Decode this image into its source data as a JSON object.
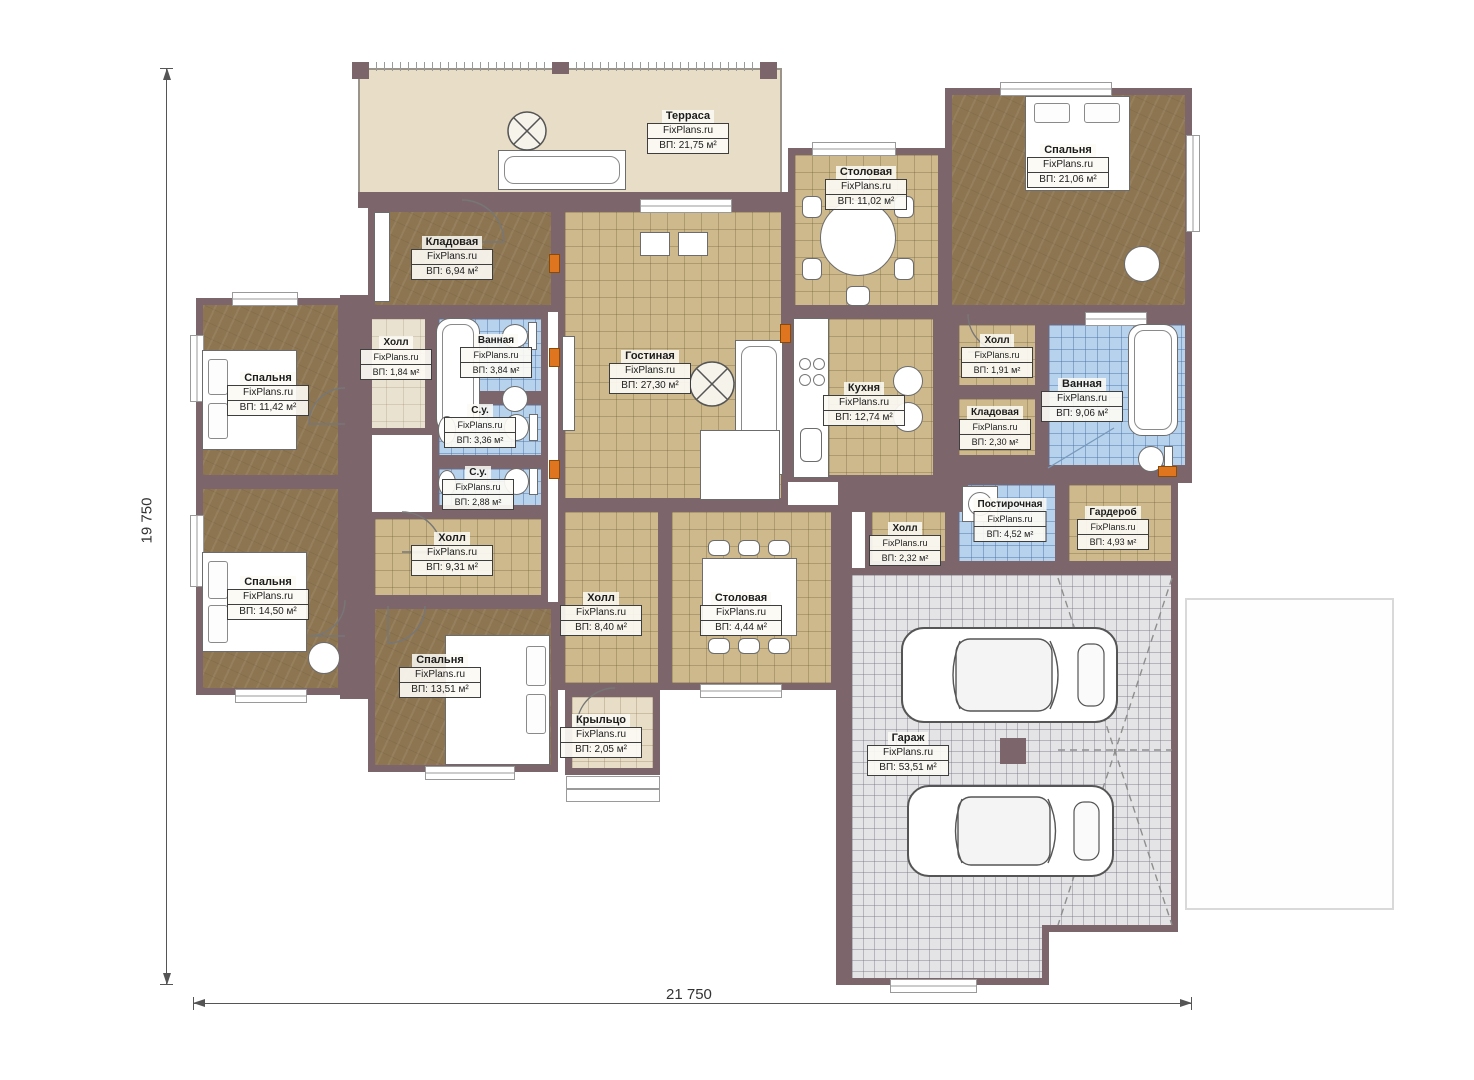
{
  "watermark": "FixPlans.ru",
  "dimensions": {
    "horizontal": "21 750",
    "vertical": "19 750"
  },
  "palette": {
    "wall": "#7c666b",
    "wood": "#8d7551",
    "tile": "#cdb98c",
    "blue": "#b7d2ec",
    "garage": "#e4e4e6",
    "terrace": "#e8ddc6",
    "accent": "#e0751f"
  },
  "rooms": [
    {
      "name": "Терраса",
      "area": "ВП: 21,75 м²"
    },
    {
      "name": "Столовая",
      "area": "ВП: 11,02 м²"
    },
    {
      "name": "Спальня",
      "area": "ВП: 21,06 м²"
    },
    {
      "name": "Кладовая",
      "area": "ВП: 6,94 м²"
    },
    {
      "name": "Холл",
      "area": "ВП: 1,84 м²"
    },
    {
      "name": "Ванная",
      "area": "ВП: 3,84 м²"
    },
    {
      "name": "С.у.",
      "area": "ВП: 3,36 м²"
    },
    {
      "name": "С.у.",
      "area": "ВП: 2,88 м²"
    },
    {
      "name": "Гостиная",
      "area": "ВП: 27,30 м²"
    },
    {
      "name": "Спальня",
      "area": "ВП: 11,42 м²"
    },
    {
      "name": "Спальня",
      "area": "ВП: 14,50 м²"
    },
    {
      "name": "Холл",
      "area": "ВП: 9,31 м²"
    },
    {
      "name": "Спальня",
      "area": "ВП: 13,51 м²"
    },
    {
      "name": "Холл",
      "area": "ВП: 8,40 м²"
    },
    {
      "name": "Столовая",
      "area": "ВП: 4,44 м²"
    },
    {
      "name": "Крыльцо",
      "area": "ВП: 2,05 м²"
    },
    {
      "name": "Кухня",
      "area": "ВП: 12,74 м²"
    },
    {
      "name": "Холл",
      "area": "ВП: 1,91 м²"
    },
    {
      "name": "Кладовая",
      "area": "ВП: 2,30 м²"
    },
    {
      "name": "Ванная",
      "area": "ВП: 9,06 м²"
    },
    {
      "name": "Холл",
      "area": "ВП: 2,32 м²"
    },
    {
      "name": "Постирочная",
      "area": "ВП: 4,52 м²"
    },
    {
      "name": "Гардероб",
      "area": "ВП: 4,93 м²"
    },
    {
      "name": "Гараж",
      "area": "ВП: 53,51 м²"
    }
  ]
}
